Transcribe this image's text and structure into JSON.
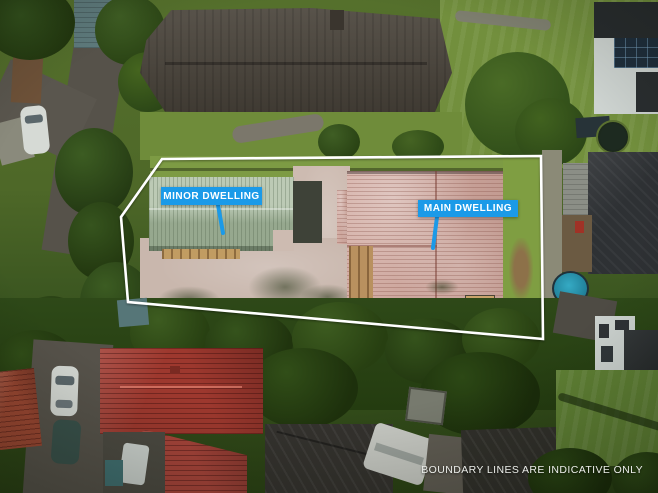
{
  "annotations": {
    "minor_dwelling": {
      "label": "MINOR DWELLING"
    },
    "main_dwelling": {
      "label": "MAIN DWELLING"
    },
    "disclaimer": "BOUNDARY LINES ARE INDICATIVE ONLY",
    "boundary_points": "162,159 541,156 543,339 128,302 121,217",
    "minor_callout": {
      "x1": 218,
      "y1": 205,
      "x2": 223,
      "y2": 233
    },
    "main_callout": {
      "x1": 437,
      "y1": 217,
      "x2": 433,
      "y2": 248
    },
    "colors": {
      "label_background": "#1b9ae8",
      "label_text": "#ffffff",
      "boundary_line": "#ffffff",
      "disclaimer_text": "#eceeea"
    }
  },
  "scene": {
    "type": "aerial-drone-photo",
    "feature_colors": {
      "minor_dwelling_green_roof": "#abbda3",
      "main_dwelling_pink_roof": "#cfa59b",
      "paved_driveway": "#cdbbb1",
      "lawn": "#728f3d",
      "trees": "#2a4215",
      "north_neighbor_roof": "#4a443b",
      "southwest_neighbor_red_roof": "#9d382e",
      "round_pool": "#2b9cb8",
      "asphalt_road": "#56524a",
      "timber_deck": "#c19c62"
    }
  }
}
